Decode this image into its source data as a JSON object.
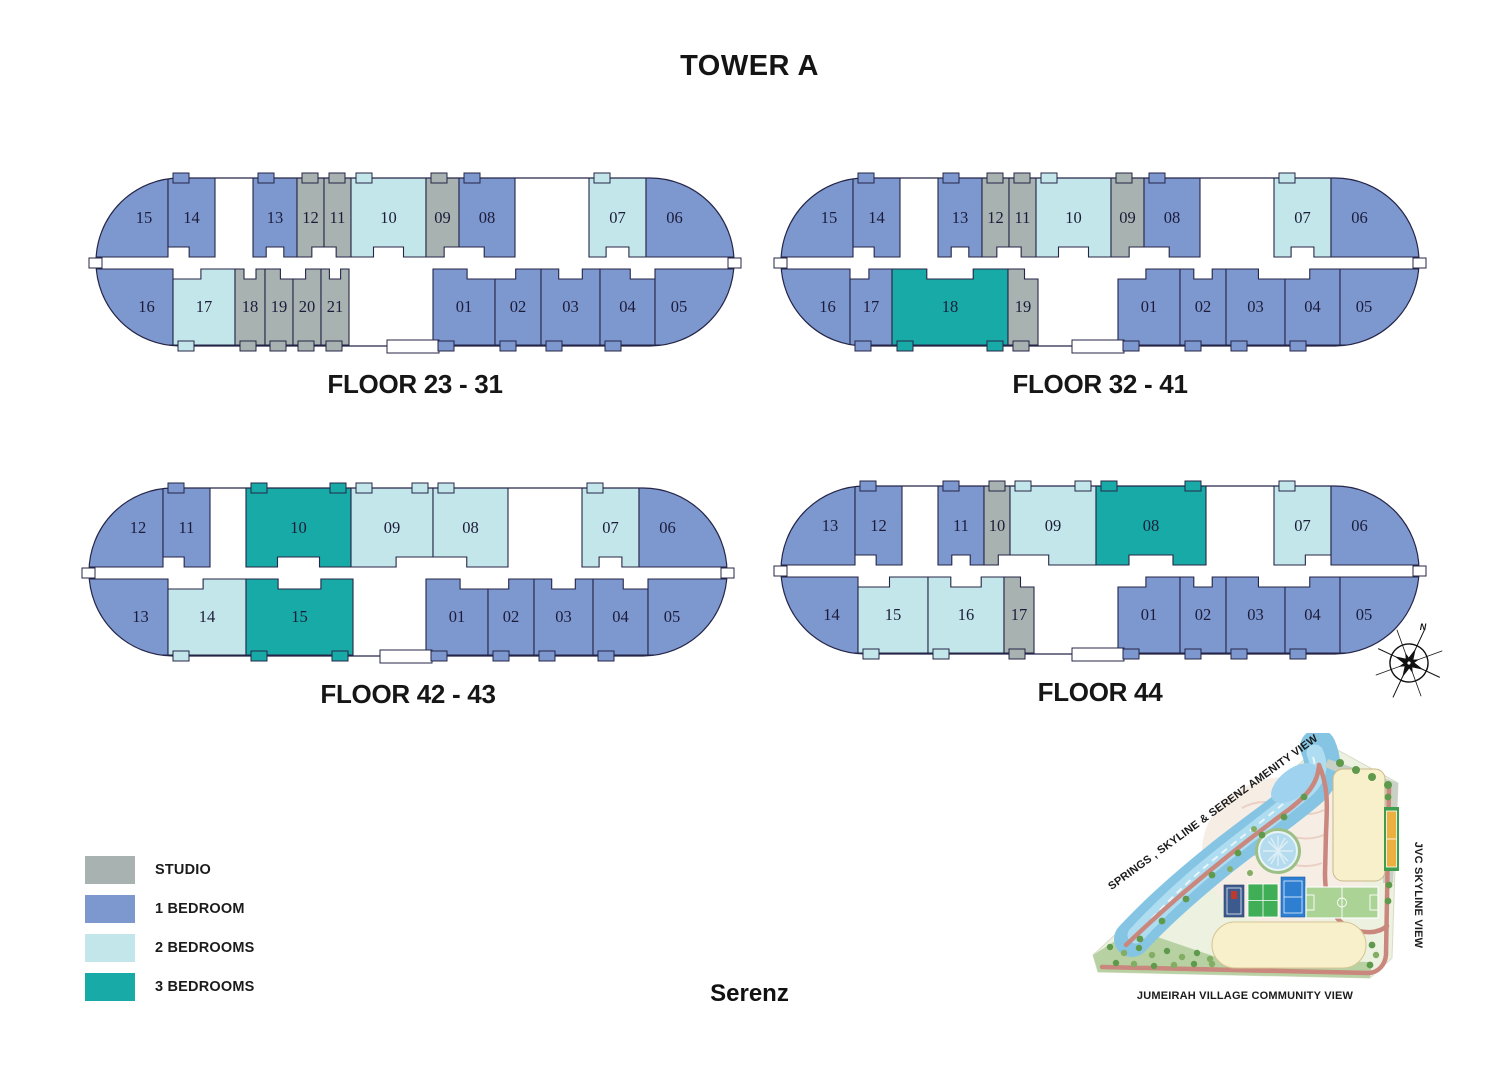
{
  "title": "TOWER A",
  "brand": "Serenz",
  "unit_colors": {
    "st": "#a8b2b1",
    "br1": "#7d97cf",
    "br2": "#c3e6ea",
    "br3": "#18aaa7"
  },
  "outline_color": "#252547",
  "legend": [
    {
      "label": "STUDIO",
      "type": "st"
    },
    {
      "label": "1 BEDROOM",
      "type": "br1"
    },
    {
      "label": "2 BEDROOMS",
      "type": "br2"
    },
    {
      "label": "3 BEDROOMS",
      "type": "br3"
    }
  ],
  "floor_plans": [
    {
      "label": "FLOOR 23 - 31",
      "top": [
        {
          "no": "15",
          "t": "br1",
          "x1": 2,
          "x2": 73
        },
        {
          "no": "14",
          "t": "br1",
          "x1": 73,
          "x2": 120
        },
        {
          "no": "13",
          "t": "br1",
          "x1": 158,
          "x2": 202
        },
        {
          "no": "12",
          "t": "st",
          "x1": 202,
          "x2": 229
        },
        {
          "no": "11",
          "t": "st",
          "x1": 229,
          "x2": 256
        },
        {
          "no": "10",
          "t": "br2",
          "x1": 256,
          "x2": 331
        },
        {
          "no": "09",
          "t": "st",
          "x1": 331,
          "x2": 364
        },
        {
          "no": "08",
          "t": "br1",
          "x1": 364,
          "x2": 420
        },
        {
          "no": "07",
          "t": "br2",
          "x1": 494,
          "x2": 551
        },
        {
          "no": "06",
          "t": "br1",
          "x1": 551,
          "x2": 638
        }
      ],
      "bottom": [
        {
          "no": "16",
          "t": "br1",
          "x1": 2,
          "x2": 78
        },
        {
          "no": "17",
          "t": "br2",
          "x1": 78,
          "x2": 140
        },
        {
          "no": "18",
          "t": "st",
          "x1": 140,
          "x2": 170
        },
        {
          "no": "19",
          "t": "st",
          "x1": 170,
          "x2": 198
        },
        {
          "no": "20",
          "t": "st",
          "x1": 198,
          "x2": 226
        },
        {
          "no": "21",
          "t": "st",
          "x1": 226,
          "x2": 254
        },
        {
          "no": "01",
          "t": "br1",
          "x1": 338,
          "x2": 400
        },
        {
          "no": "02",
          "t": "br1",
          "x1": 400,
          "x2": 446
        },
        {
          "no": "03",
          "t": "br1",
          "x1": 446,
          "x2": 505
        },
        {
          "no": "04",
          "t": "br1",
          "x1": 505,
          "x2": 560
        },
        {
          "no": "05",
          "t": "br1",
          "x1": 560,
          "x2": 638
        }
      ]
    },
    {
      "label": "FLOOR 32 - 41",
      "top": [
        {
          "no": "15",
          "t": "br1",
          "x1": 2,
          "x2": 73
        },
        {
          "no": "14",
          "t": "br1",
          "x1": 73,
          "x2": 120
        },
        {
          "no": "13",
          "t": "br1",
          "x1": 158,
          "x2": 202
        },
        {
          "no": "12",
          "t": "st",
          "x1": 202,
          "x2": 229
        },
        {
          "no": "11",
          "t": "st",
          "x1": 229,
          "x2": 256
        },
        {
          "no": "10",
          "t": "br2",
          "x1": 256,
          "x2": 331
        },
        {
          "no": "09",
          "t": "st",
          "x1": 331,
          "x2": 364
        },
        {
          "no": "08",
          "t": "br1",
          "x1": 364,
          "x2": 420
        },
        {
          "no": "07",
          "t": "br2",
          "x1": 494,
          "x2": 551
        },
        {
          "no": "06",
          "t": "br1",
          "x1": 551,
          "x2": 638
        }
      ],
      "bottom": [
        {
          "no": "16",
          "t": "br1",
          "x1": 2,
          "x2": 70
        },
        {
          "no": "17",
          "t": "br1",
          "x1": 70,
          "x2": 112
        },
        {
          "no": "18",
          "t": "br3",
          "x1": 112,
          "x2": 228
        },
        {
          "no": "19",
          "t": "st",
          "x1": 228,
          "x2": 258
        },
        {
          "no": "01",
          "t": "br1",
          "x1": 338,
          "x2": 400
        },
        {
          "no": "02",
          "t": "br1",
          "x1": 400,
          "x2": 446
        },
        {
          "no": "03",
          "t": "br1",
          "x1": 446,
          "x2": 505
        },
        {
          "no": "04",
          "t": "br1",
          "x1": 505,
          "x2": 560
        },
        {
          "no": "05",
          "t": "br1",
          "x1": 560,
          "x2": 638
        }
      ]
    },
    {
      "label": "FLOOR 42 - 43",
      "top": [
        {
          "no": "12",
          "t": "br1",
          "x1": 2,
          "x2": 75
        },
        {
          "no": "11",
          "t": "br1",
          "x1": 75,
          "x2": 122
        },
        {
          "no": "10",
          "t": "br3",
          "x1": 158,
          "x2": 263
        },
        {
          "no": "09",
          "t": "br2",
          "x1": 263,
          "x2": 345
        },
        {
          "no": "08",
          "t": "br2",
          "x1": 345,
          "x2": 420
        },
        {
          "no": "07",
          "t": "br2",
          "x1": 494,
          "x2": 551
        },
        {
          "no": "06",
          "t": "br1",
          "x1": 551,
          "x2": 638
        }
      ],
      "bottom": [
        {
          "no": "13",
          "t": "br1",
          "x1": 2,
          "x2": 80
        },
        {
          "no": "14",
          "t": "br2",
          "x1": 80,
          "x2": 158
        },
        {
          "no": "15",
          "t": "br3",
          "x1": 158,
          "x2": 265
        },
        {
          "no": "01",
          "t": "br1",
          "x1": 338,
          "x2": 400
        },
        {
          "no": "02",
          "t": "br1",
          "x1": 400,
          "x2": 446
        },
        {
          "no": "03",
          "t": "br1",
          "x1": 446,
          "x2": 505
        },
        {
          "no": "04",
          "t": "br1",
          "x1": 505,
          "x2": 560
        },
        {
          "no": "05",
          "t": "br1",
          "x1": 560,
          "x2": 638
        }
      ]
    },
    {
      "label": "FLOOR 44",
      "top": [
        {
          "no": "13",
          "t": "br1",
          "x1": 2,
          "x2": 75
        },
        {
          "no": "12",
          "t": "br1",
          "x1": 75,
          "x2": 122
        },
        {
          "no": "11",
          "t": "br1",
          "x1": 158,
          "x2": 204
        },
        {
          "no": "10",
          "t": "st",
          "x1": 204,
          "x2": 230
        },
        {
          "no": "09",
          "t": "br2",
          "x1": 230,
          "x2": 316
        },
        {
          "no": "08",
          "t": "br3",
          "x1": 316,
          "x2": 426
        },
        {
          "no": "07",
          "t": "br2",
          "x1": 494,
          "x2": 551
        },
        {
          "no": "06",
          "t": "br1",
          "x1": 551,
          "x2": 638
        }
      ],
      "bottom": [
        {
          "no": "14",
          "t": "br1",
          "x1": 2,
          "x2": 78
        },
        {
          "no": "15",
          "t": "br2",
          "x1": 78,
          "x2": 148
        },
        {
          "no": "16",
          "t": "br2",
          "x1": 148,
          "x2": 224
        },
        {
          "no": "17",
          "t": "st",
          "x1": 224,
          "x2": 254
        },
        {
          "no": "01",
          "t": "br1",
          "x1": 338,
          "x2": 400
        },
        {
          "no": "02",
          "t": "br1",
          "x1": 400,
          "x2": 446
        },
        {
          "no": "03",
          "t": "br1",
          "x1": 446,
          "x2": 505
        },
        {
          "no": "04",
          "t": "br1",
          "x1": 505,
          "x2": 560
        },
        {
          "no": "05",
          "t": "br1",
          "x1": 560,
          "x2": 638
        }
      ]
    }
  ],
  "site_map": {
    "label_top": "SPRINGS , SKYLINE & SERENZ AMENITY VIEW",
    "label_right": "JVC SKYLINE VIEW",
    "label_bottom": "JUMEIRAH VILLAGE COMMUNITY VIEW"
  },
  "compass_label": "N"
}
